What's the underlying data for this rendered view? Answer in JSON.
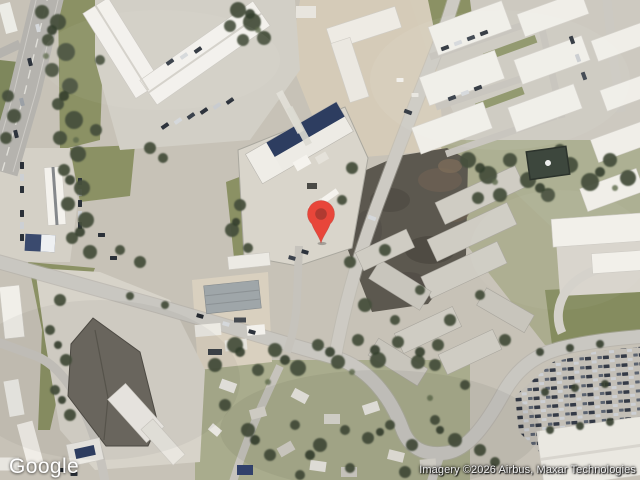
{
  "map": {
    "type": "satellite-imagery",
    "pin": {
      "label": "location-pin",
      "fill": "#E8463A",
      "inner_fill": "#B03A31",
      "x": 321,
      "y": 243
    }
  },
  "footer": {
    "logo_text": "Google",
    "attribution_text": "Imagery ©2026 Airbus, Maxar Technologies"
  }
}
